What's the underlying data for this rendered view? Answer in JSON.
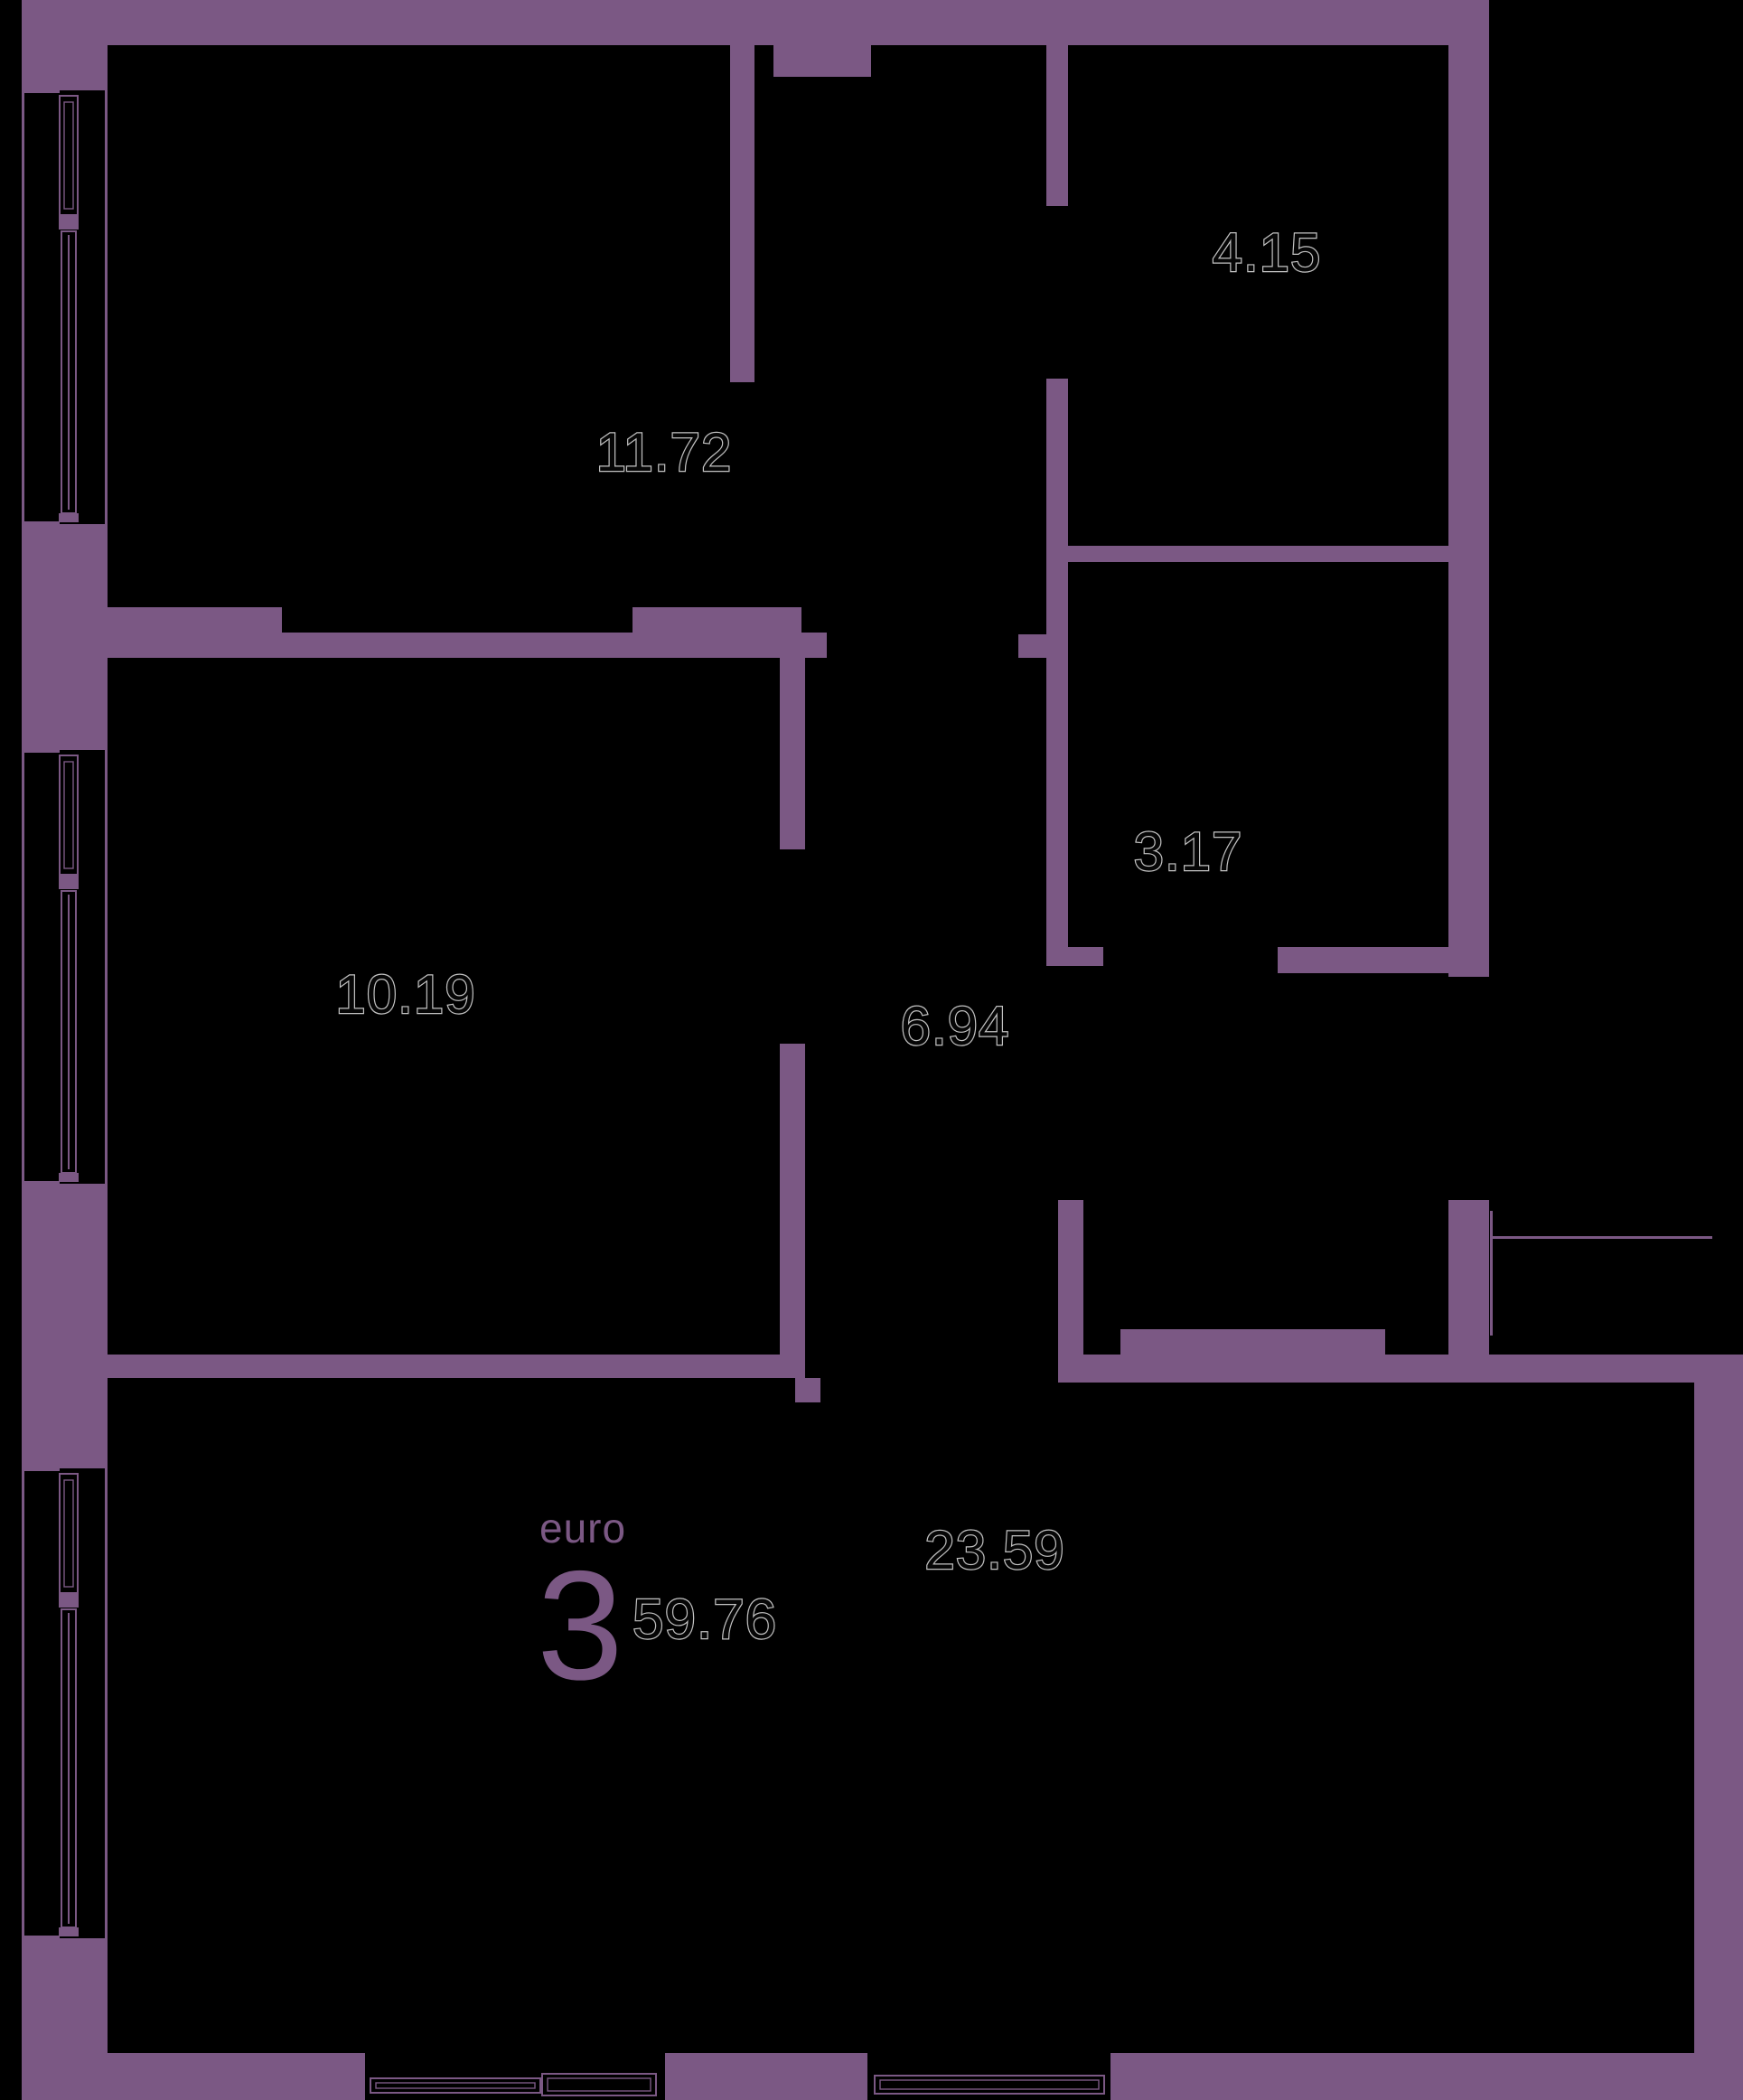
{
  "plan": {
    "badge": {
      "type_label": "euro",
      "rooms_count": "3",
      "total_area": "59.76"
    },
    "rooms": [
      {
        "id": "room-top-left",
        "area": "11.72"
      },
      {
        "id": "room-top-right",
        "area": "4.15"
      },
      {
        "id": "room-mid-right",
        "area": "3.17"
      },
      {
        "id": "room-mid-left",
        "area": "10.19"
      },
      {
        "id": "hallway",
        "area": "6.94"
      },
      {
        "id": "living-room",
        "area": "23.59"
      }
    ],
    "colors": {
      "wall": "#7B5884",
      "background": "#000000",
      "accent_text": "#7B5884",
      "area_text_fill": "#060606",
      "area_text_outline": "#c2c2c2"
    }
  }
}
